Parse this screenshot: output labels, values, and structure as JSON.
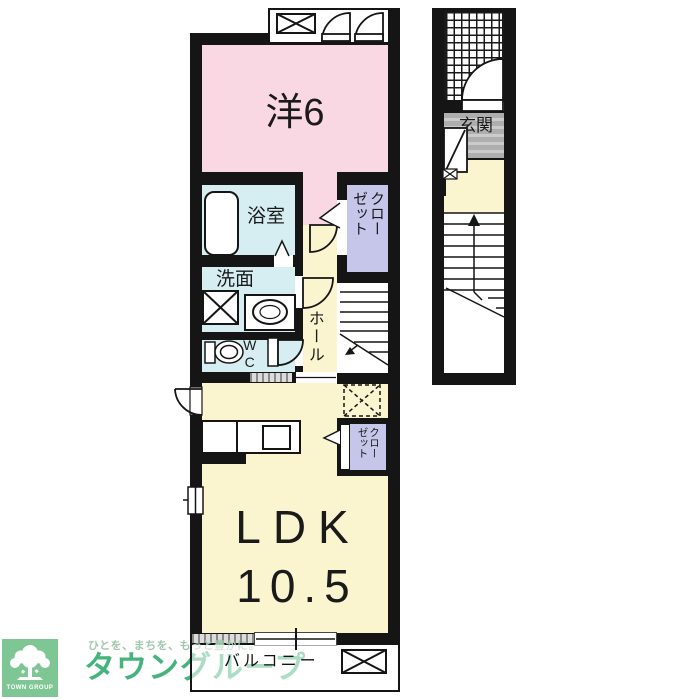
{
  "floorplan": {
    "rooms": {
      "western_room": {
        "label": "洋6"
      },
      "bathroom": {
        "label": "浴室"
      },
      "washroom": {
        "label": "洗面"
      },
      "wc": {
        "label": "WC"
      },
      "hall": {
        "label": "ホール"
      },
      "closet_upper": {
        "col1": "クロー",
        "col2": "ゼット"
      },
      "closet_ldk": {
        "col1": "クロー",
        "col2": "ゼット"
      },
      "entrance": {
        "label": "玄関"
      },
      "ldk": {
        "label": "LDK",
        "area": "10.5"
      },
      "balcony": {
        "label": "バルコニー"
      }
    },
    "colors": {
      "room_pink": "#f9d8e3",
      "room_blue": "#d6edf2",
      "room_lavender": "#c5c6ea",
      "room_cream": "#faf4cf",
      "wall": "#151515",
      "entrance_tile_gray": "#b5b5b5"
    }
  },
  "branding": {
    "logo_caption": "TOWN GROUP",
    "tagline": "ひとを、まちを、もっと豊かに。",
    "company": "タウングループ",
    "logo_green": "#7ec795",
    "text_green": "#45b37c",
    "tagline_green": "#a0c7ad"
  }
}
